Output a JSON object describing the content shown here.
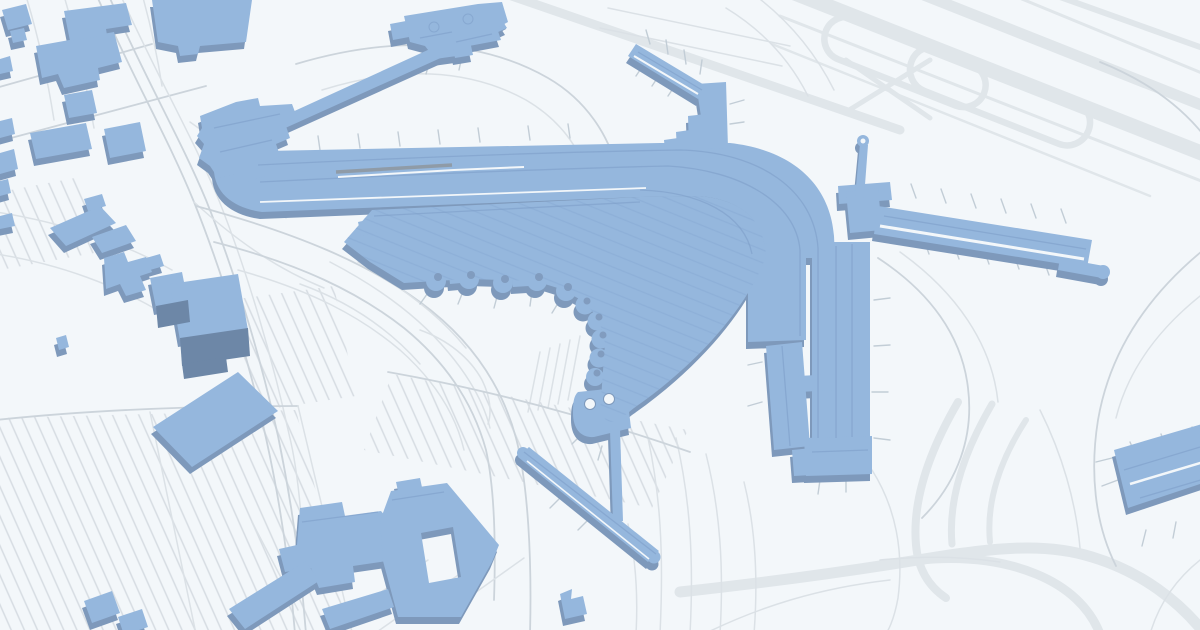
{
  "page": {
    "title": "Isometric 3D airport terminal map",
    "description": "Stylized aerial map of an airport: blue extruded terminal buildings with circular gate pods, concourse piers, an elevated walkway, people-mover line, parking lots, access roads and runways on a pale background. No text labels are rendered."
  },
  "colors": {
    "background": "#f3f7fa",
    "road": "#ccd4db",
    "road_light": "#dbe1e6",
    "runway": "#e0e6ea",
    "lot_line": "#d6dce2",
    "building_top": "#95b7dd",
    "building_side": "#7e99bb",
    "building_dark": "#6d87a7",
    "terminal_line": "#7b9cc6",
    "tick": "#c2cdd6",
    "hatch": "#86a8d2",
    "slot": "#8f9ba7"
  },
  "map": {
    "type": "isometric-airport-map",
    "features": [
      "parallel runways and taxiway loops (top right)",
      "curved terminal roadway band sweeping from west to south",
      "gate apron with chain of circular gate pods",
      "north-east concourse pier with jet-bridge ticks",
      "east concourse pier with jet-bridge ticks",
      "control tower",
      "elevated walkway to north building",
      "people-mover / AirTrain line (bottom center)",
      "remote stand building (bottom right)",
      "hotel and office blocks (bottom left)",
      "surface parking lots with stall rows (left)",
      "access highway and loop roads"
    ]
  }
}
